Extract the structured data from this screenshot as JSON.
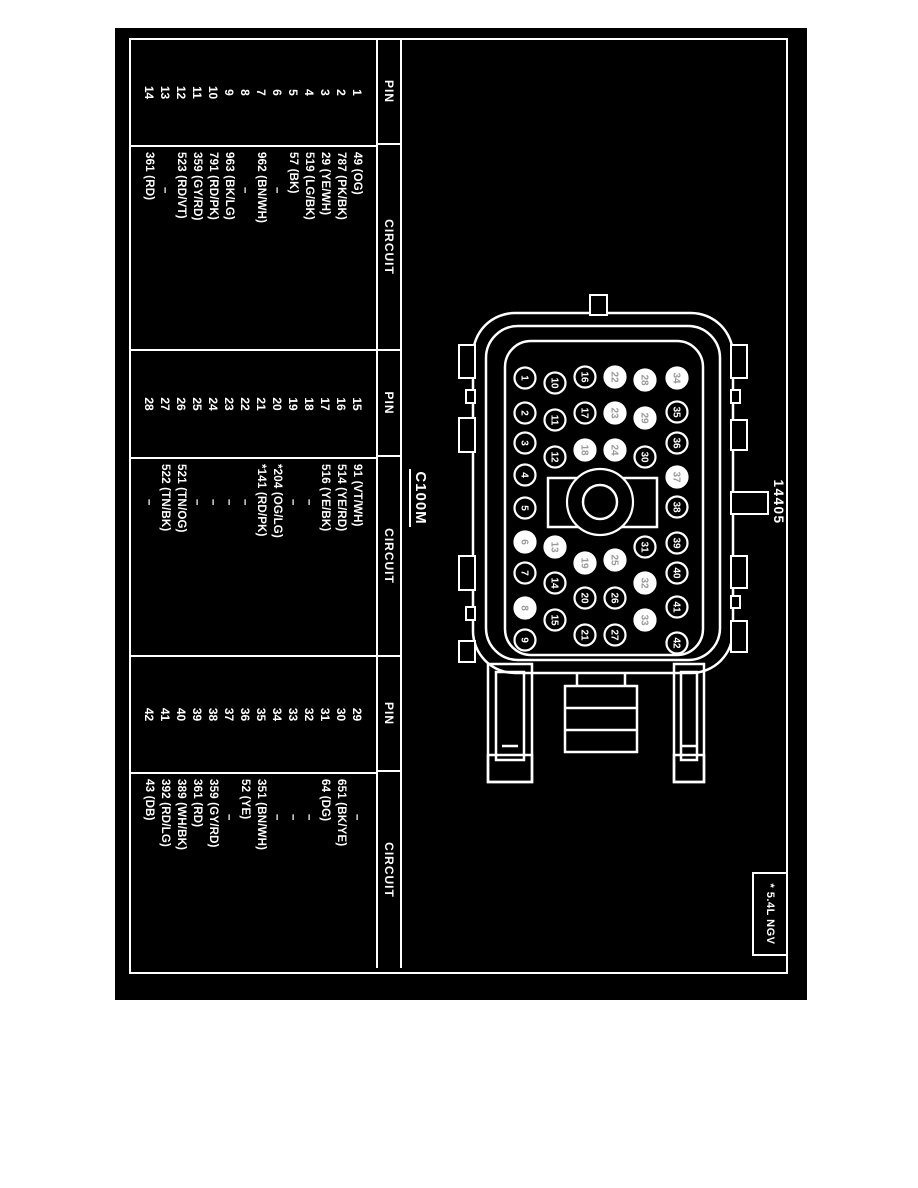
{
  "figure": {
    "part_number": "14405",
    "connector_id": "C100M",
    "footnote": "* 5.4L NGV"
  },
  "colors": {
    "ink": "#ffffff",
    "paper": "#000000",
    "faint_pin_number": "#9a9a9a"
  },
  "tables": [
    {
      "headers": {
        "pin": "PIN",
        "circuit": "CIRCUIT"
      },
      "rows": [
        {
          "pin": "1",
          "circuit": "49 (OG)"
        },
        {
          "pin": "2",
          "circuit": "787 (PK/BK)"
        },
        {
          "pin": "3",
          "circuit": "29 (YE/WH)"
        },
        {
          "pin": "4",
          "circuit": "519 (LG/BK)"
        },
        {
          "pin": "5",
          "circuit": "57 (BK)"
        },
        {
          "pin": "6",
          "circuit": "–"
        },
        {
          "pin": "7",
          "circuit": "962 (BN/WH)"
        },
        {
          "pin": "8",
          "circuit": "–"
        },
        {
          "pin": "9",
          "circuit": "963 (BK/LG)"
        },
        {
          "pin": "10",
          "circuit": "791 (RD/PK)"
        },
        {
          "pin": "11",
          "circuit": "359 (GY/RD)"
        },
        {
          "pin": "12",
          "circuit": "523 (RD/VT)"
        },
        {
          "pin": "13",
          "circuit": "–"
        },
        {
          "pin": "14",
          "circuit": "361 (RD)"
        }
      ]
    },
    {
      "headers": {
        "pin": "PIN",
        "circuit": "CIRCUIT"
      },
      "rows": [
        {
          "pin": "15",
          "circuit": "91 (VT/WH)"
        },
        {
          "pin": "16",
          "circuit": "514 (YE/RD)"
        },
        {
          "pin": "17",
          "circuit": "516 (YE/BK)"
        },
        {
          "pin": "18",
          "circuit": "–"
        },
        {
          "pin": "19",
          "circuit": "–"
        },
        {
          "pin": "20",
          "circuit": "*204 (OG/LG)"
        },
        {
          "pin": "21",
          "circuit": "*141 (RD/PK)"
        },
        {
          "pin": "22",
          "circuit": "–"
        },
        {
          "pin": "23",
          "circuit": "–"
        },
        {
          "pin": "24",
          "circuit": "–"
        },
        {
          "pin": "25",
          "circuit": "–"
        },
        {
          "pin": "26",
          "circuit": "521 (TN/OG)"
        },
        {
          "pin": "27",
          "circuit": "522 (TN/BK)"
        },
        {
          "pin": "28",
          "circuit": "–"
        }
      ]
    },
    {
      "headers": {
        "pin": "PIN",
        "circuit": "CIRCUIT"
      },
      "rows": [
        {
          "pin": "29",
          "circuit": "–"
        },
        {
          "pin": "30",
          "circuit": "651 (BK/YE)"
        },
        {
          "pin": "31",
          "circuit": "64 (DG)"
        },
        {
          "pin": "32",
          "circuit": "–"
        },
        {
          "pin": "33",
          "circuit": "–"
        },
        {
          "pin": "34",
          "circuit": "–"
        },
        {
          "pin": "35",
          "circuit": "351 (BN/WH)"
        },
        {
          "pin": "36",
          "circuit": "52 (YE)"
        },
        {
          "pin": "37",
          "circuit": "–"
        },
        {
          "pin": "38",
          "circuit": "359 (GY/RD)"
        },
        {
          "pin": "39",
          "circuit": "361 (RD)"
        },
        {
          "pin": "40",
          "circuit": "389 (WH/BK)"
        },
        {
          "pin": "41",
          "circuit": "392 (RD/LG)"
        },
        {
          "pin": "42",
          "circuit": "43 (DB)"
        }
      ]
    }
  ],
  "connector": {
    "pins": [
      {
        "n": "1",
        "x": 378,
        "y": 393,
        "filled": false
      },
      {
        "n": "2",
        "x": 413,
        "y": 393,
        "filled": false
      },
      {
        "n": "3",
        "x": 443,
        "y": 393,
        "filled": false
      },
      {
        "n": "4",
        "x": 475,
        "y": 393,
        "filled": false
      },
      {
        "n": "5",
        "x": 508,
        "y": 393,
        "filled": false
      },
      {
        "n": "6",
        "x": 542,
        "y": 393,
        "filled": true
      },
      {
        "n": "7",
        "x": 573,
        "y": 393,
        "filled": false
      },
      {
        "n": "8",
        "x": 608,
        "y": 393,
        "filled": true
      },
      {
        "n": "9",
        "x": 640,
        "y": 393,
        "filled": false
      },
      {
        "n": "10",
        "x": 383,
        "y": 363,
        "filled": false
      },
      {
        "n": "11",
        "x": 420,
        "y": 363,
        "filled": false
      },
      {
        "n": "12",
        "x": 457,
        "y": 363,
        "filled": false
      },
      {
        "n": "13",
        "x": 547,
        "y": 363,
        "filled": true
      },
      {
        "n": "14",
        "x": 583,
        "y": 363,
        "filled": false
      },
      {
        "n": "15",
        "x": 620,
        "y": 363,
        "filled": false
      },
      {
        "n": "16",
        "x": 377,
        "y": 333,
        "filled": false
      },
      {
        "n": "17",
        "x": 413,
        "y": 333,
        "filled": false
      },
      {
        "n": "18",
        "x": 450,
        "y": 333,
        "filled": true
      },
      {
        "n": "19",
        "x": 563,
        "y": 333,
        "filled": true
      },
      {
        "n": "20",
        "x": 598,
        "y": 333,
        "filled": false
      },
      {
        "n": "21",
        "x": 635,
        "y": 333,
        "filled": false
      },
      {
        "n": "22",
        "x": 377,
        "y": 303,
        "filled": true
      },
      {
        "n": "23",
        "x": 413,
        "y": 303,
        "filled": true
      },
      {
        "n": "24",
        "x": 450,
        "y": 303,
        "filled": true
      },
      {
        "n": "25",
        "x": 560,
        "y": 303,
        "filled": true
      },
      {
        "n": "26",
        "x": 598,
        "y": 303,
        "filled": false
      },
      {
        "n": "27",
        "x": 635,
        "y": 303,
        "filled": false
      },
      {
        "n": "28",
        "x": 380,
        "y": 273,
        "filled": true
      },
      {
        "n": "29",
        "x": 418,
        "y": 273,
        "filled": true
      },
      {
        "n": "30",
        "x": 457,
        "y": 273,
        "filled": false
      },
      {
        "n": "31",
        "x": 547,
        "y": 273,
        "filled": false
      },
      {
        "n": "32",
        "x": 583,
        "y": 273,
        "filled": true
      },
      {
        "n": "33",
        "x": 620,
        "y": 273,
        "filled": true
      },
      {
        "n": "34",
        "x": 378,
        "y": 241,
        "filled": true
      },
      {
        "n": "35",
        "x": 412,
        "y": 241,
        "filled": false
      },
      {
        "n": "36",
        "x": 443,
        "y": 241,
        "filled": false
      },
      {
        "n": "37",
        "x": 477,
        "y": 241,
        "filled": true
      },
      {
        "n": "38",
        "x": 507,
        "y": 241,
        "filled": false
      },
      {
        "n": "39",
        "x": 543,
        "y": 241,
        "filled": false
      },
      {
        "n": "40",
        "x": 573,
        "y": 241,
        "filled": false
      },
      {
        "n": "41",
        "x": 607,
        "y": 241,
        "filled": false
      },
      {
        "n": "42",
        "x": 643,
        "y": 241,
        "filled": false
      }
    ]
  }
}
